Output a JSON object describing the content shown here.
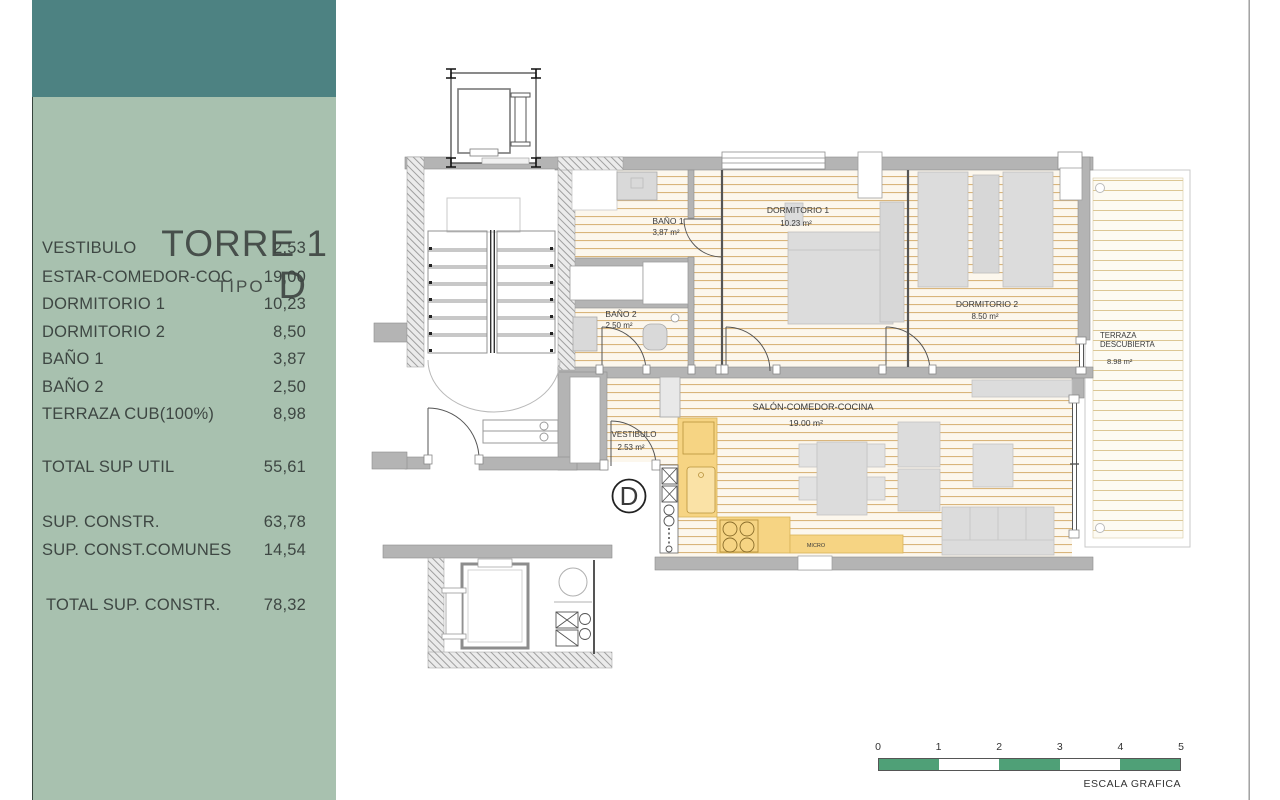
{
  "sidebar": {
    "title": "TORRE 1",
    "subtitle_label": "TIPO",
    "subtitle_value": "D",
    "colors": {
      "band": "#4d8282",
      "panel": "#a8c1af"
    },
    "rows": [
      {
        "label": "VESTIBULO",
        "value": "2,53"
      },
      {
        "label": "ESTAR-COMEDOR-COC",
        "value": "19,00"
      },
      {
        "label": "DORMITORIO 1",
        "value": "10,23"
      },
      {
        "label": "DORMITORIO 2",
        "value": "8,50"
      },
      {
        "label": "BAÑO 1",
        "value": "3,87"
      },
      {
        "label": "BAÑO 2",
        "value": "2,50"
      },
      {
        "label": "TERRAZA CUB(100%)",
        "value": "8,98"
      }
    ],
    "total_util": {
      "label": "TOTAL SUP UTIL",
      "value": "55,61"
    },
    "constr": {
      "label": "SUP. CONSTR.",
      "value": "63,78"
    },
    "comunes": {
      "label": "SUP. CONST.COMUNES",
      "value": "14,54"
    },
    "total_constr": {
      "label": "TOTAL SUP. CONSTR.",
      "value": "78,32"
    }
  },
  "plan": {
    "unit_label": "D",
    "micro_label": "MICRO",
    "colors": {
      "kitchen": "#f6d483",
      "wall": "#b4b4b4",
      "floor_line": "#d9b57b"
    },
    "rooms": {
      "bano1": {
        "name": "BAÑO 1",
        "area": "3,87 m²"
      },
      "dorm1": {
        "name": "DORMITORIO 1",
        "area": "10.23 m²"
      },
      "dorm2": {
        "name": "DORMITORIO 2",
        "area": "8.50 m²"
      },
      "bano2": {
        "name": "BAÑO 2",
        "area": "2.50 m²"
      },
      "vestibulo": {
        "name": "VESTIBULO",
        "area": "2.53 m²"
      },
      "salon": {
        "name": "SALÓN-COMEDOR-COCINA",
        "area": "19.00 m²"
      },
      "terraza": {
        "line1": "TERRAZA",
        "line2": "DESCUBIERTA",
        "area": "8.98 m²"
      }
    }
  },
  "scale_bar": {
    "ticks": [
      "0",
      "1",
      "2",
      "3",
      "4",
      "5"
    ],
    "caption": "ESCALA GRAFICA",
    "green": "#4fa077"
  }
}
